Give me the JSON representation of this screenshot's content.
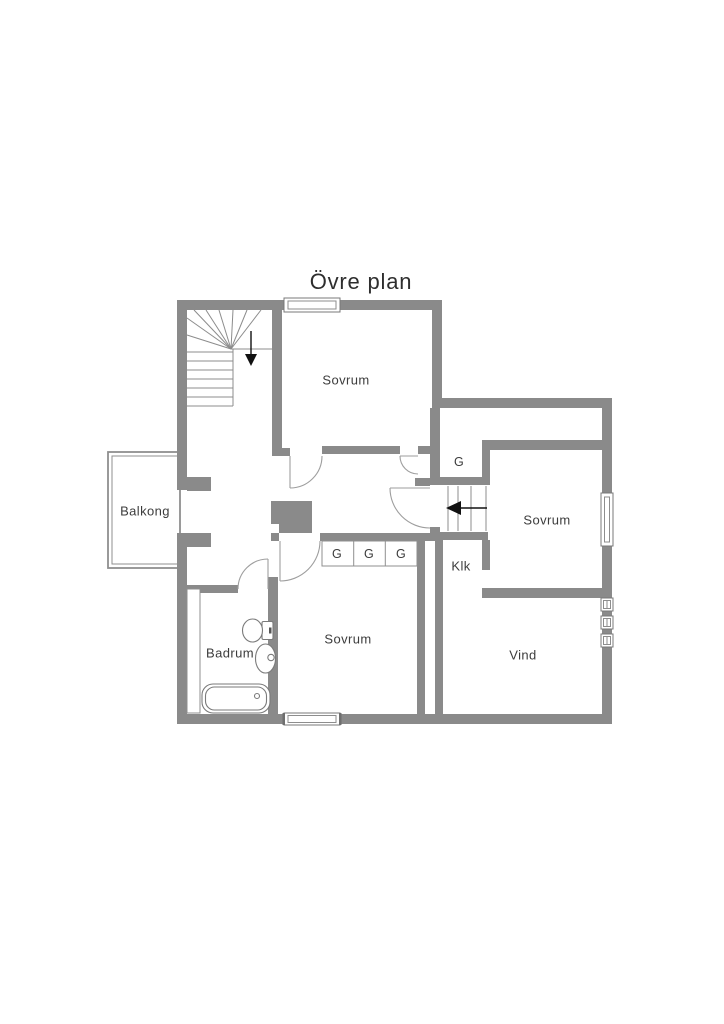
{
  "title": "Övre plan",
  "labels": {
    "balcony": "Balkong",
    "bedroom_top": "Sovrum",
    "bedroom_right": "Sovrum",
    "bedroom_bottom": "Sovrum",
    "bathroom": "Badrum",
    "attic": "Vind",
    "walk_in_closet": "Klk",
    "wardrobe_hall": "G",
    "wardrobe_1": "G",
    "wardrobe_2": "G",
    "wardrobe_3": "G"
  },
  "colors": {
    "wall": "#8a8a8a",
    "thin_line": "#8f8f8f",
    "fixture_line": "#7a7a7a",
    "door_arc": "#9e9e9e",
    "text": "#3c3c3c",
    "arrow": "#111111",
    "background": "#ffffff"
  }
}
